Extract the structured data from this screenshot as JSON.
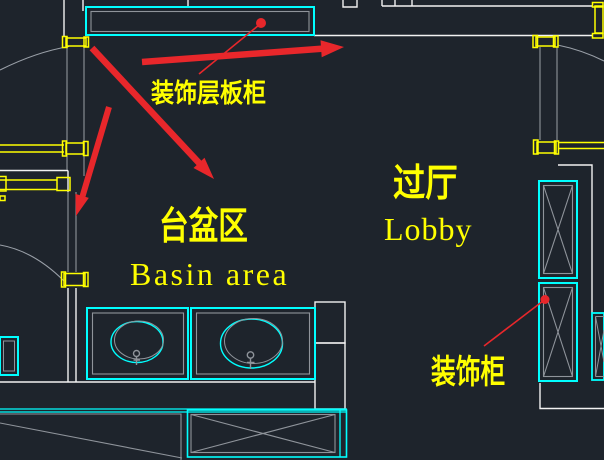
{
  "labels": {
    "shelf_cabinet": "装饰层板柜",
    "basin_area_zh": "台盆区",
    "basin_area_en": "Basin area",
    "lobby_zh": "过厅",
    "lobby_en": "Lobby",
    "decor_cabinet": "装饰柜"
  },
  "colors": {
    "background": "#1e242c",
    "wall_white": "#f2f2f2",
    "detail_gray": "#8f949b",
    "fixture_cyan": "#00ffff",
    "frame_yellow": "#ffff00",
    "annotation_red": "#e8272b",
    "label_yellow": "#ffff00"
  }
}
